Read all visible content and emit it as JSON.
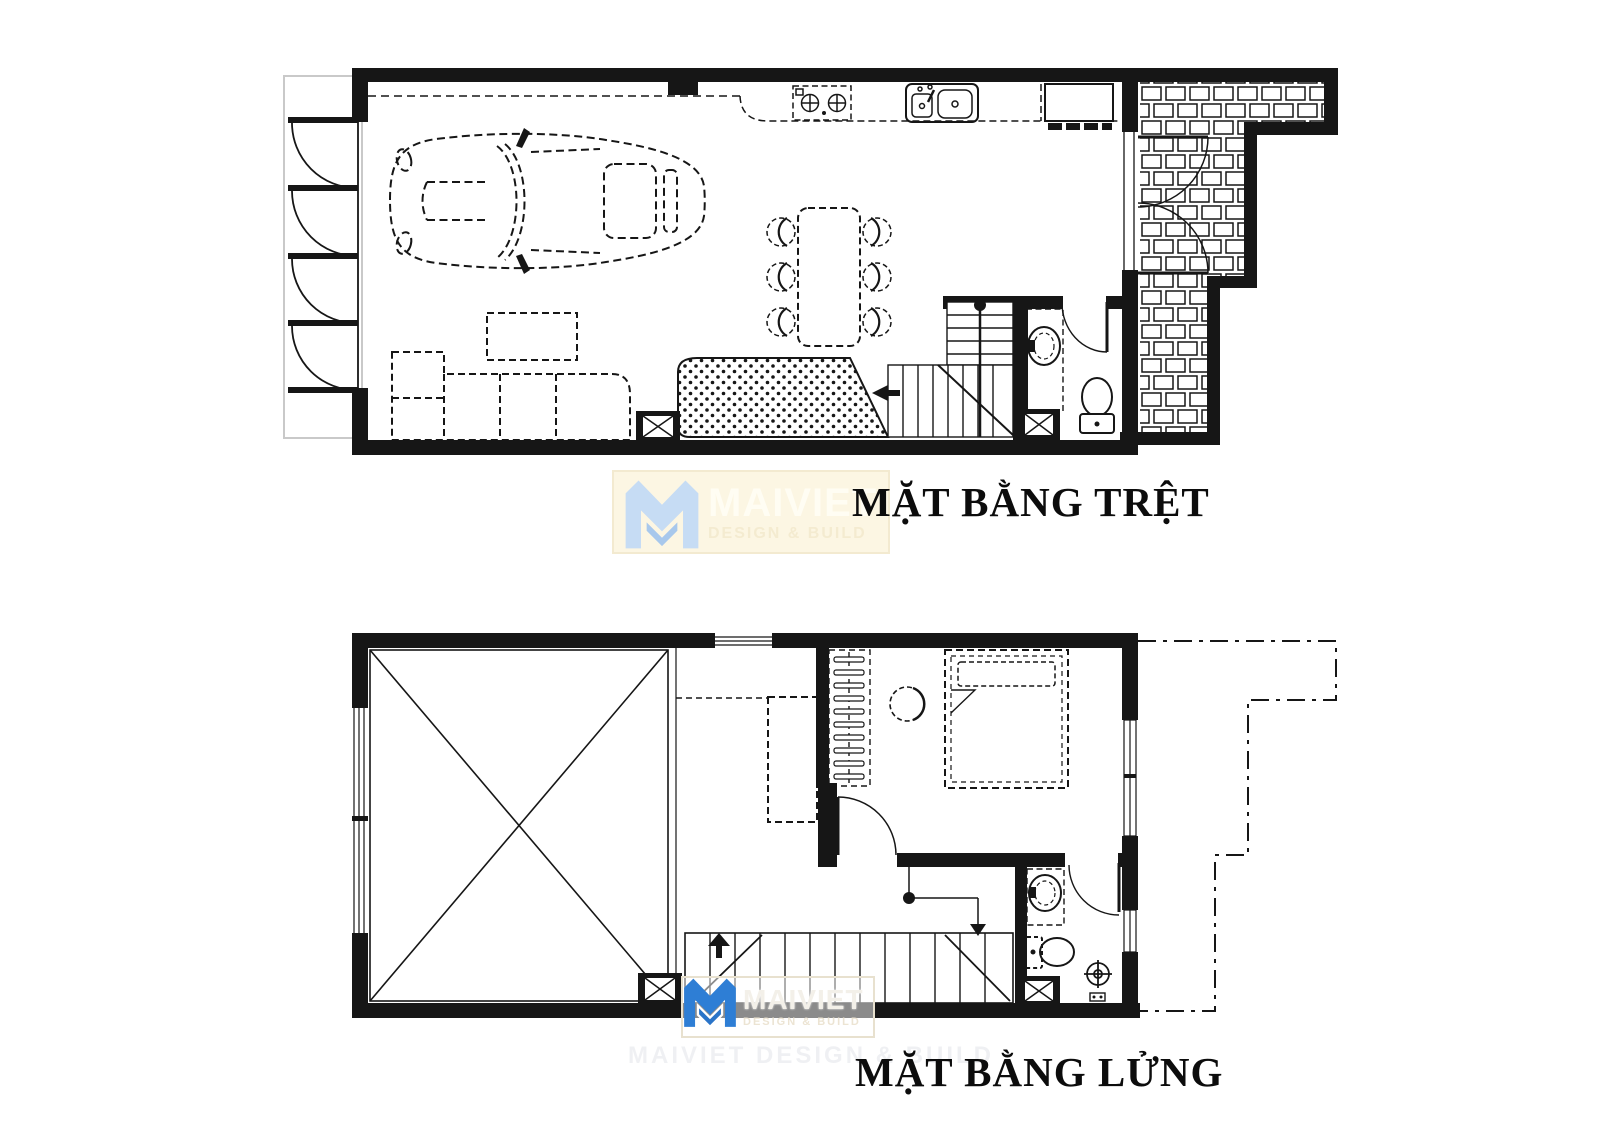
{
  "page": {
    "background": "#ffffff",
    "ink": "#161616",
    "recess_outline": "#c9c9c9"
  },
  "ground_plan": {
    "title": "MẶT BẰNG TRỆT",
    "fixtures": [
      "car",
      "folding-garage-doors",
      "kitchen-counter",
      "stove",
      "kitchen-sink",
      "fridge",
      "dining-table",
      "dining-chairs",
      "sofa",
      "coffee-table",
      "dotted-rug",
      "staircase",
      "wc-basin",
      "toilet",
      "shaft",
      "patio-double-door",
      "tiled-patio"
    ]
  },
  "mezzanine_plan": {
    "title": "MẶT BẰNG LỬNG",
    "fixtures": [
      "double-height-void",
      "railing",
      "wardrobe",
      "desk",
      "chair",
      "double-bed",
      "bedroom-door",
      "staircase",
      "bath-basin",
      "toilet",
      "floor-drain",
      "shower-mixer",
      "shaft",
      "windows",
      "setback-line"
    ]
  },
  "watermarks": {
    "top": {
      "brand": "MAIVIET",
      "tagline": "DESIGN & BUILD",
      "box_bg": "#fcf6e3",
      "logo_color": "#c6dcf4",
      "logo_color2": "#a8c8ec",
      "brand_color": "#fffdf3",
      "tagline_color": "#f4ebd0"
    },
    "bottom": {
      "brand": "MAIVIET",
      "tagline": "DESIGN & BUILD",
      "box_bg": "rgba(255,255,255,0.5)",
      "logo_color": "#2e7ed5",
      "logo_color2": "#2a74c8",
      "brand_color": "#f3f0e9",
      "tagline_color": "#ece4d3"
    },
    "ghost_text": "MAIVIET DESIGN & BUILD"
  }
}
